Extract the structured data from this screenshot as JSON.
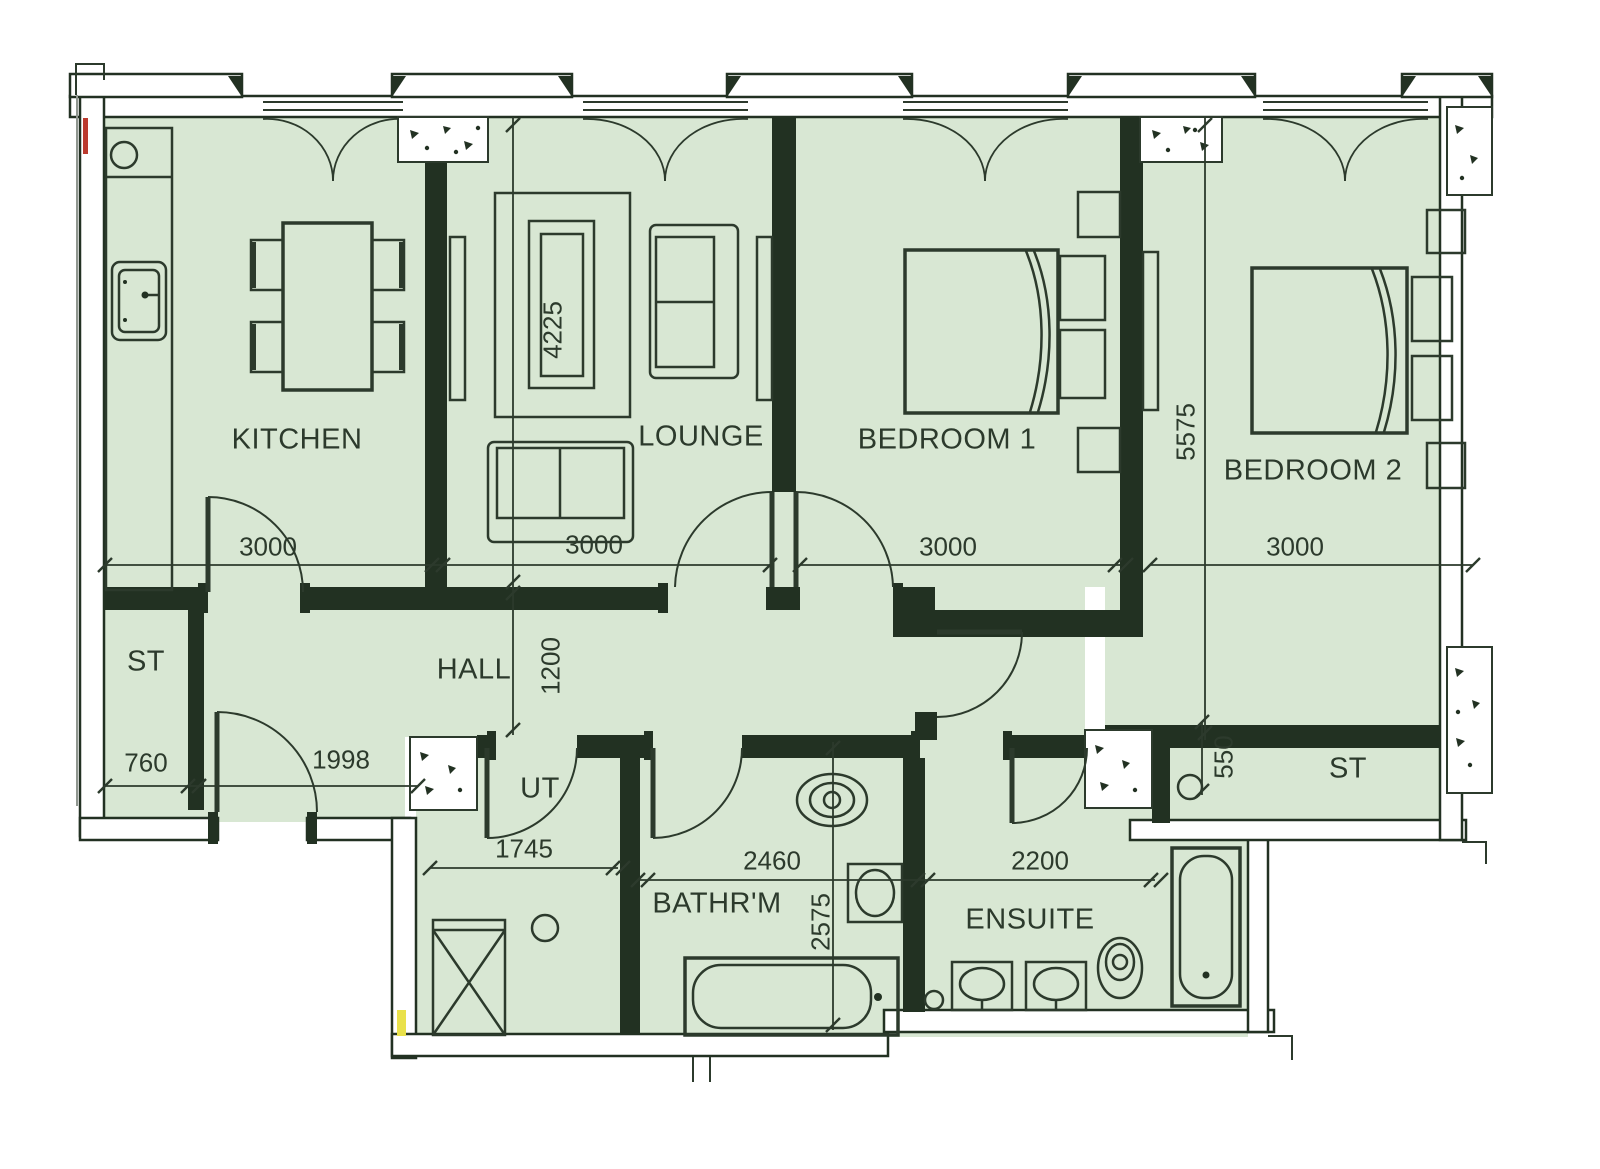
{
  "colors": {
    "room_fill": "#d8e7d3",
    "wall": "#223122",
    "line": "#2c3a2c",
    "text": "#2c3a2c",
    "marker_red": "#bb3a2e",
    "marker_yellow": "#e9e14b"
  },
  "rooms": [
    {
      "id": "kitchen",
      "label": "KITCHEN"
    },
    {
      "id": "lounge",
      "label": "LOUNGE"
    },
    {
      "id": "bedroom-1",
      "label": "BEDROOM 1"
    },
    {
      "id": "bedroom-2",
      "label": "BEDROOM 2"
    },
    {
      "id": "hall",
      "label": "HALL"
    },
    {
      "id": "store-left",
      "label": "ST"
    },
    {
      "id": "utility",
      "label": "UT"
    },
    {
      "id": "bathroom",
      "label": "BATHR'M"
    },
    {
      "id": "ensuite",
      "label": "ENSUITE"
    },
    {
      "id": "store-right",
      "label": "ST"
    }
  ],
  "dimensions_mm": [
    {
      "id": "kitchen-width",
      "value": "3000"
    },
    {
      "id": "lounge-width",
      "value": "3000"
    },
    {
      "id": "bedroom1-width",
      "value": "3000"
    },
    {
      "id": "bedroom2-width",
      "value": "3000"
    },
    {
      "id": "lounge-depth",
      "value": "4225"
    },
    {
      "id": "bedroom2-depth",
      "value": "5575"
    },
    {
      "id": "hall-width",
      "value": "1200"
    },
    {
      "id": "store-left-width",
      "value": "760"
    },
    {
      "id": "entrance-width",
      "value": "1998"
    },
    {
      "id": "utility-width",
      "value": "1745"
    },
    {
      "id": "bathroom-width",
      "value": "2460"
    },
    {
      "id": "ensuite-width",
      "value": "2200"
    },
    {
      "id": "bathroom-depth",
      "value": "2575"
    },
    {
      "id": "store-right-depth",
      "value": "550"
    }
  ]
}
